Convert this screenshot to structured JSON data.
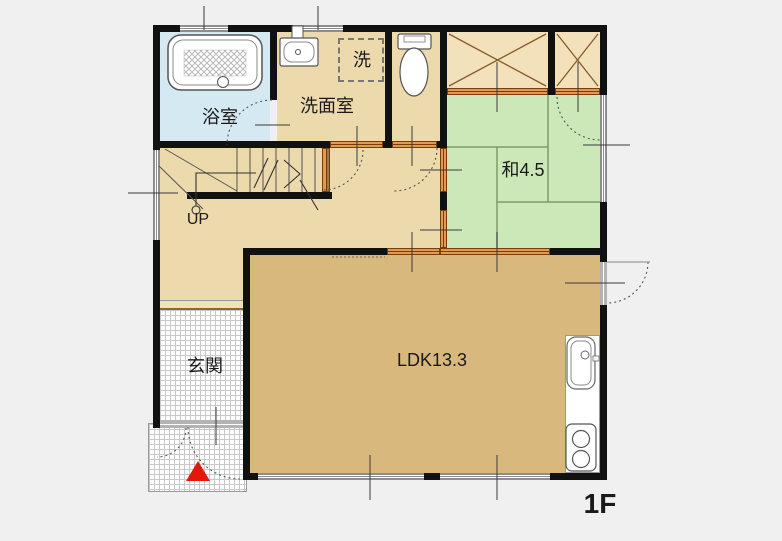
{
  "floor_plan": {
    "floor_label": "1F",
    "stairs": {
      "direction_label": "UP"
    },
    "rooms": {
      "bathroom": {
        "label": "浴室",
        "floor_color": "#d4e9f2"
      },
      "washroom": {
        "label": "洗面室",
        "floor_color": "#ecd9ac"
      },
      "laundry_space": {
        "label": "洗"
      },
      "japanese_room": {
        "label": "和4.5",
        "floor_color": "#cde8b8"
      },
      "ldk": {
        "label": "LDK13.3",
        "floor_color": "#d9b87e"
      },
      "entrance": {
        "label": "玄関"
      }
    },
    "fixtures": [
      "bathtub",
      "washbasin",
      "washing-machine-space",
      "toilet",
      "kitchen-sink",
      "stove",
      "stairs",
      "closet-x2"
    ],
    "markers": {
      "entrance_arrow": {
        "shape": "triangle",
        "color": "#e3170d"
      }
    },
    "colors": {
      "background": "#f0f0f0",
      "wall": "#111111",
      "hall_floor": "#ecd9ac",
      "closet_floor": "#f2e1ba",
      "sliding_door": "#e09a52",
      "window_frame": "#8d8d8d",
      "tatami_line": "#7d9a6b"
    }
  }
}
